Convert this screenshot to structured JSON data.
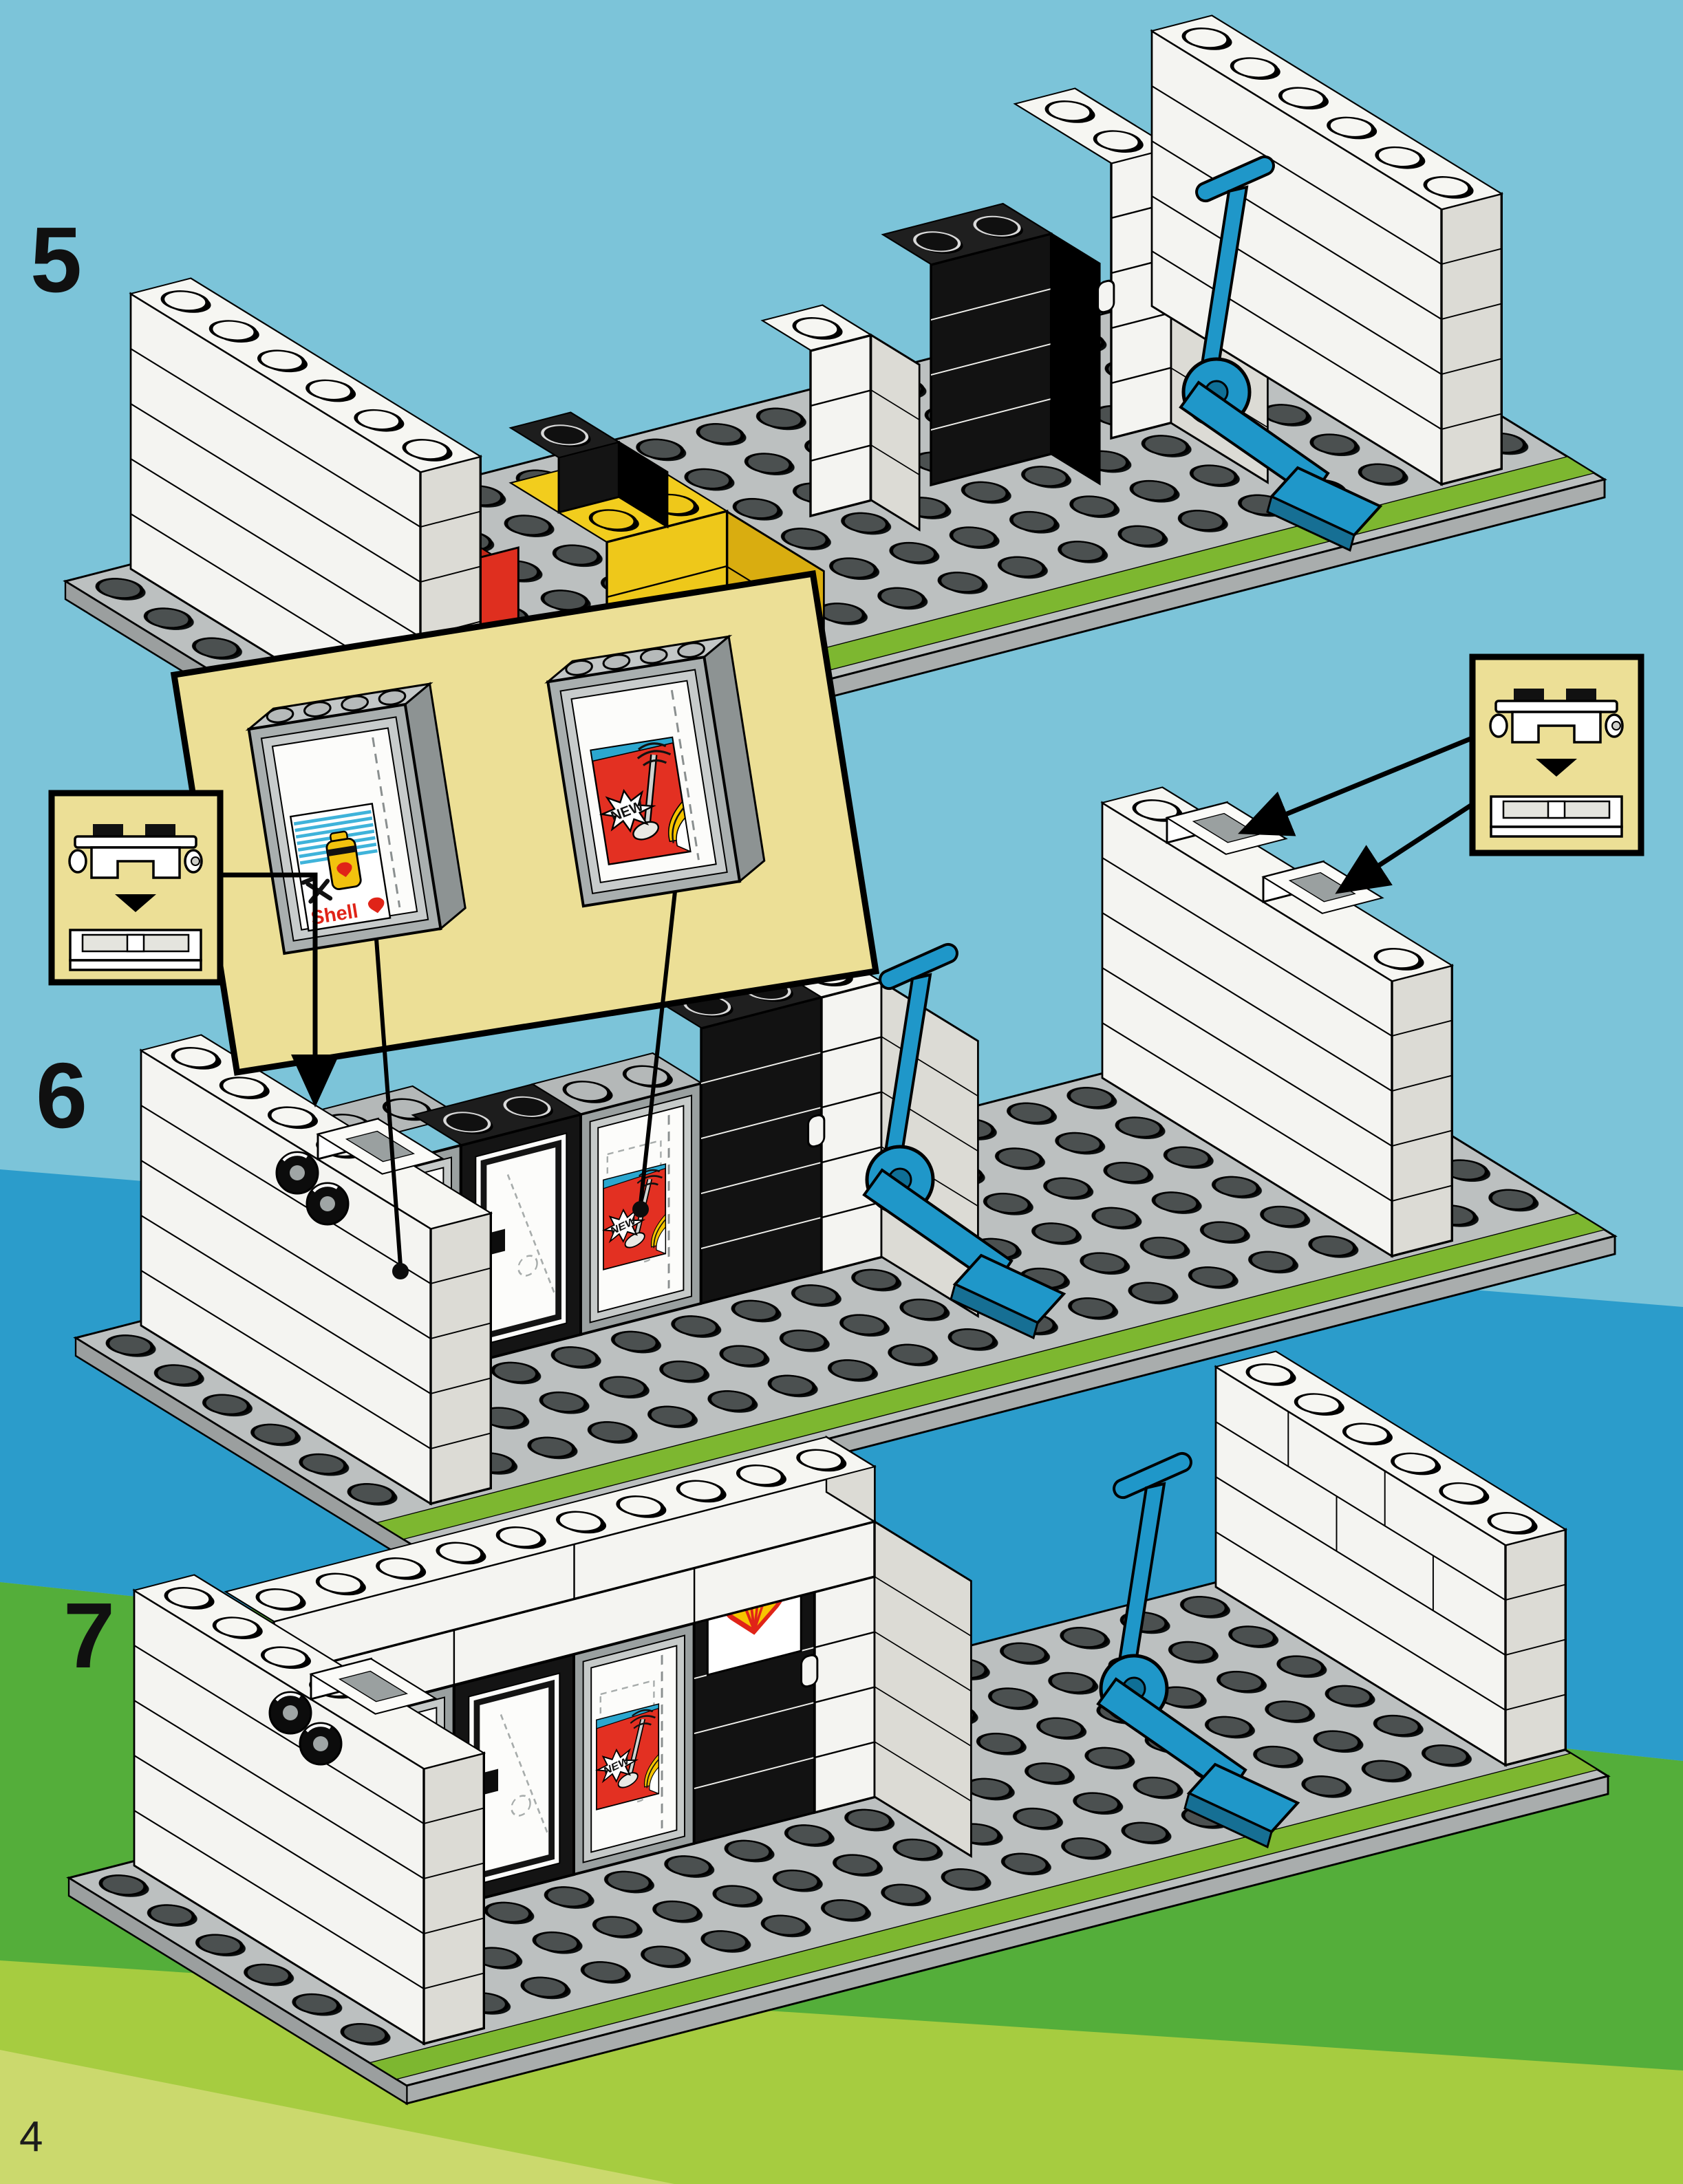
{
  "document": {
    "kind": "lego-building-instructions-page",
    "page_number": "4",
    "subject": "Shell service station shop assembly, steps 5-7"
  },
  "steps": [
    {
      "label": "5"
    },
    {
      "label": "6"
    },
    {
      "label": "7"
    }
  ],
  "insets": {
    "window_detail_panel": {
      "windows": [
        {
          "sticker": "shell-oil-can-sticker"
        },
        {
          "sticker": "new-metal-detector-sticker"
        }
      ]
    },
    "hinge_callout_left": {
      "pieces": [
        "hinge-top-piece",
        "hinge-base-piece"
      ],
      "arrow": "down-arrow-icon"
    },
    "hinge_callout_right": {
      "pieces": [
        "hinge-top-piece",
        "hinge-base-piece"
      ],
      "arrow": "down-arrow-icon"
    }
  },
  "stickers": {
    "shell_can": {
      "brand_text": "Shell",
      "icons": [
        "oil-can-icon",
        "crossed-tools-icon",
        "shell-pecten-icon"
      ]
    },
    "new_promo": {
      "label_text": "NEW",
      "icons": [
        "metal-detector-icon",
        "starburst-icon"
      ]
    }
  },
  "logos": {
    "shell_sign": {
      "icon": "shell-pecten-logo"
    }
  },
  "colors": {
    "sky": "#7cc4d9",
    "water": "#2b9ccb",
    "grass": "#54ae3a",
    "grass_light": "#a6cc40",
    "grass_pale": "#cbd96d",
    "baseplate": "#bcc0c0",
    "baseplate_stripe": "#7db730",
    "brick_white": "#f4f4f1",
    "brick_yellow": "#eec81a",
    "brick_red": "#df2f1f",
    "brick_black": "#121212",
    "truck_blue": "#1f97c9",
    "inset_yellow": "#ecdf96",
    "shell_yellow": "#f7c500",
    "shell_red": "#e02418"
  }
}
